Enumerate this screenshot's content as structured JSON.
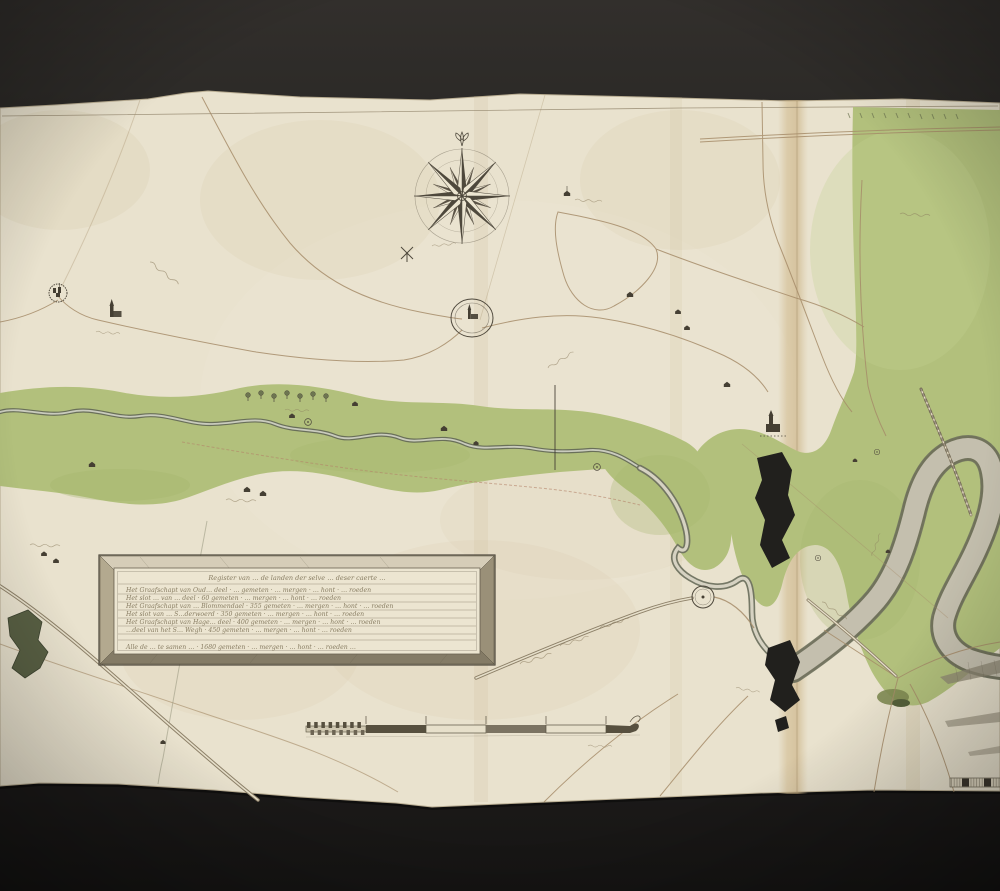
{
  "artwork": {
    "description": "Hand-drawn manuscript river map (pen, ink and green wash) photographed on a dark backdrop",
    "handwriting_note": "cursive annotations are largely illegible; strings are approximate fragments"
  },
  "palette": {
    "backdrop_top": "#302d2a",
    "backdrop_bottom": "#161514",
    "paper": "#e9e2ce",
    "fold_tan": "#d2bc92",
    "ink": "#57503f",
    "road_brown": "#a68c69",
    "floodplain_green": "#b2c07c",
    "river_edge": "#6e7260",
    "river_core": "#dcd8c7",
    "ink_blot": "#21201d"
  },
  "compass_rose": {
    "points": 16,
    "north_mark": "fleur-de-lis"
  },
  "legend": {
    "title": "Register van … de landen der selve … deser caerte …",
    "rows": [
      "Het Graafschapt van Oud… deel · … gemeten · … mergen · … hont · … roeden",
      "Het slot … van … deel · 60 gemeten · … mergen · … hont · … roeden",
      "Het Graafschapt van … Blommendael · 355 gemeten · … mergen · … hont · … roeden",
      "Het slot van … S…derwoerd · 350 gemeten · … mergen · … hont · … roeden",
      "Het Graafschapt van Hage… deel · 400 gemeten · … mergen · … hont · … roeden",
      "…deel van het S… Wegh · 450 gemeten · … mergen · … hont · … roeden"
    ],
    "total_row": "Alle de … te samen … · 1680 gemeten · … mergen · … hont · … roeden …"
  },
  "scale_bar": {
    "style": "segmented bar with chain-link left section and flourish tail",
    "tick_labels": "illegible"
  },
  "map_icons": [
    "compass-rose",
    "fortified-town",
    "church",
    "moated-village",
    "windmill",
    "farm-house",
    "tree-row",
    "lake",
    "dike-profile",
    "ink-blot"
  ]
}
